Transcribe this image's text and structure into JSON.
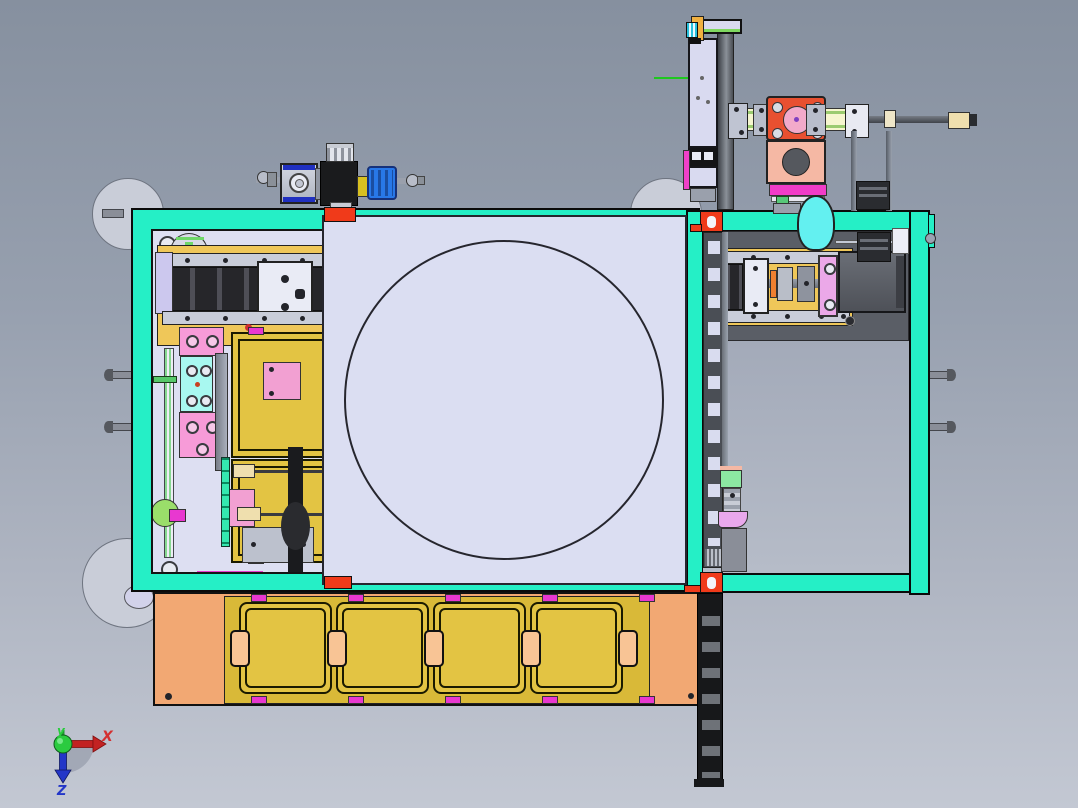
{
  "scene": {
    "description": "3D CAD viewport, top orthographic view of an automated assembly machine",
    "background_top": "#86909F",
    "background_bottom": "#C3C8D3"
  },
  "axis_triad": {
    "x_label": "X",
    "y_label": "y",
    "z_label": "Z",
    "x_color": "#D43030",
    "y_color": "#28CC3C",
    "z_color": "#2336C8"
  },
  "palette": {
    "frame_teal": "#25EFC6",
    "panel_lavender": "#DDDFF2",
    "cover_plate_lavender": "#DBDEF2",
    "tray_yellow": "#E3C443",
    "base_plate_orange": "#F2A873",
    "divider_tab_peach": "#F8C495",
    "clip_magenta": "#E838D0",
    "bracket_red": "#F03A1A",
    "stage_yellow": "#EFC759",
    "pink_block": "#F79BD8",
    "violet_plate": "#EBA8E8",
    "cyan_part": "#63F0F0",
    "salmon_mount": "#F5B8A4",
    "coupling_plate_orange": "#E85030",
    "coupling_pink": "#F2AACA",
    "shaft_cream": "#F6F6CF",
    "valve_blue": "#2878E8",
    "motor_gray": "#54575D",
    "cable_chain_dark": "#17181A"
  },
  "counts": {
    "bottom_trays": 4,
    "tray_divider_tabs": 5,
    "frame_side_pins_left": 2,
    "frame_side_pins_right": 2,
    "plate_corner_brackets": 4
  }
}
